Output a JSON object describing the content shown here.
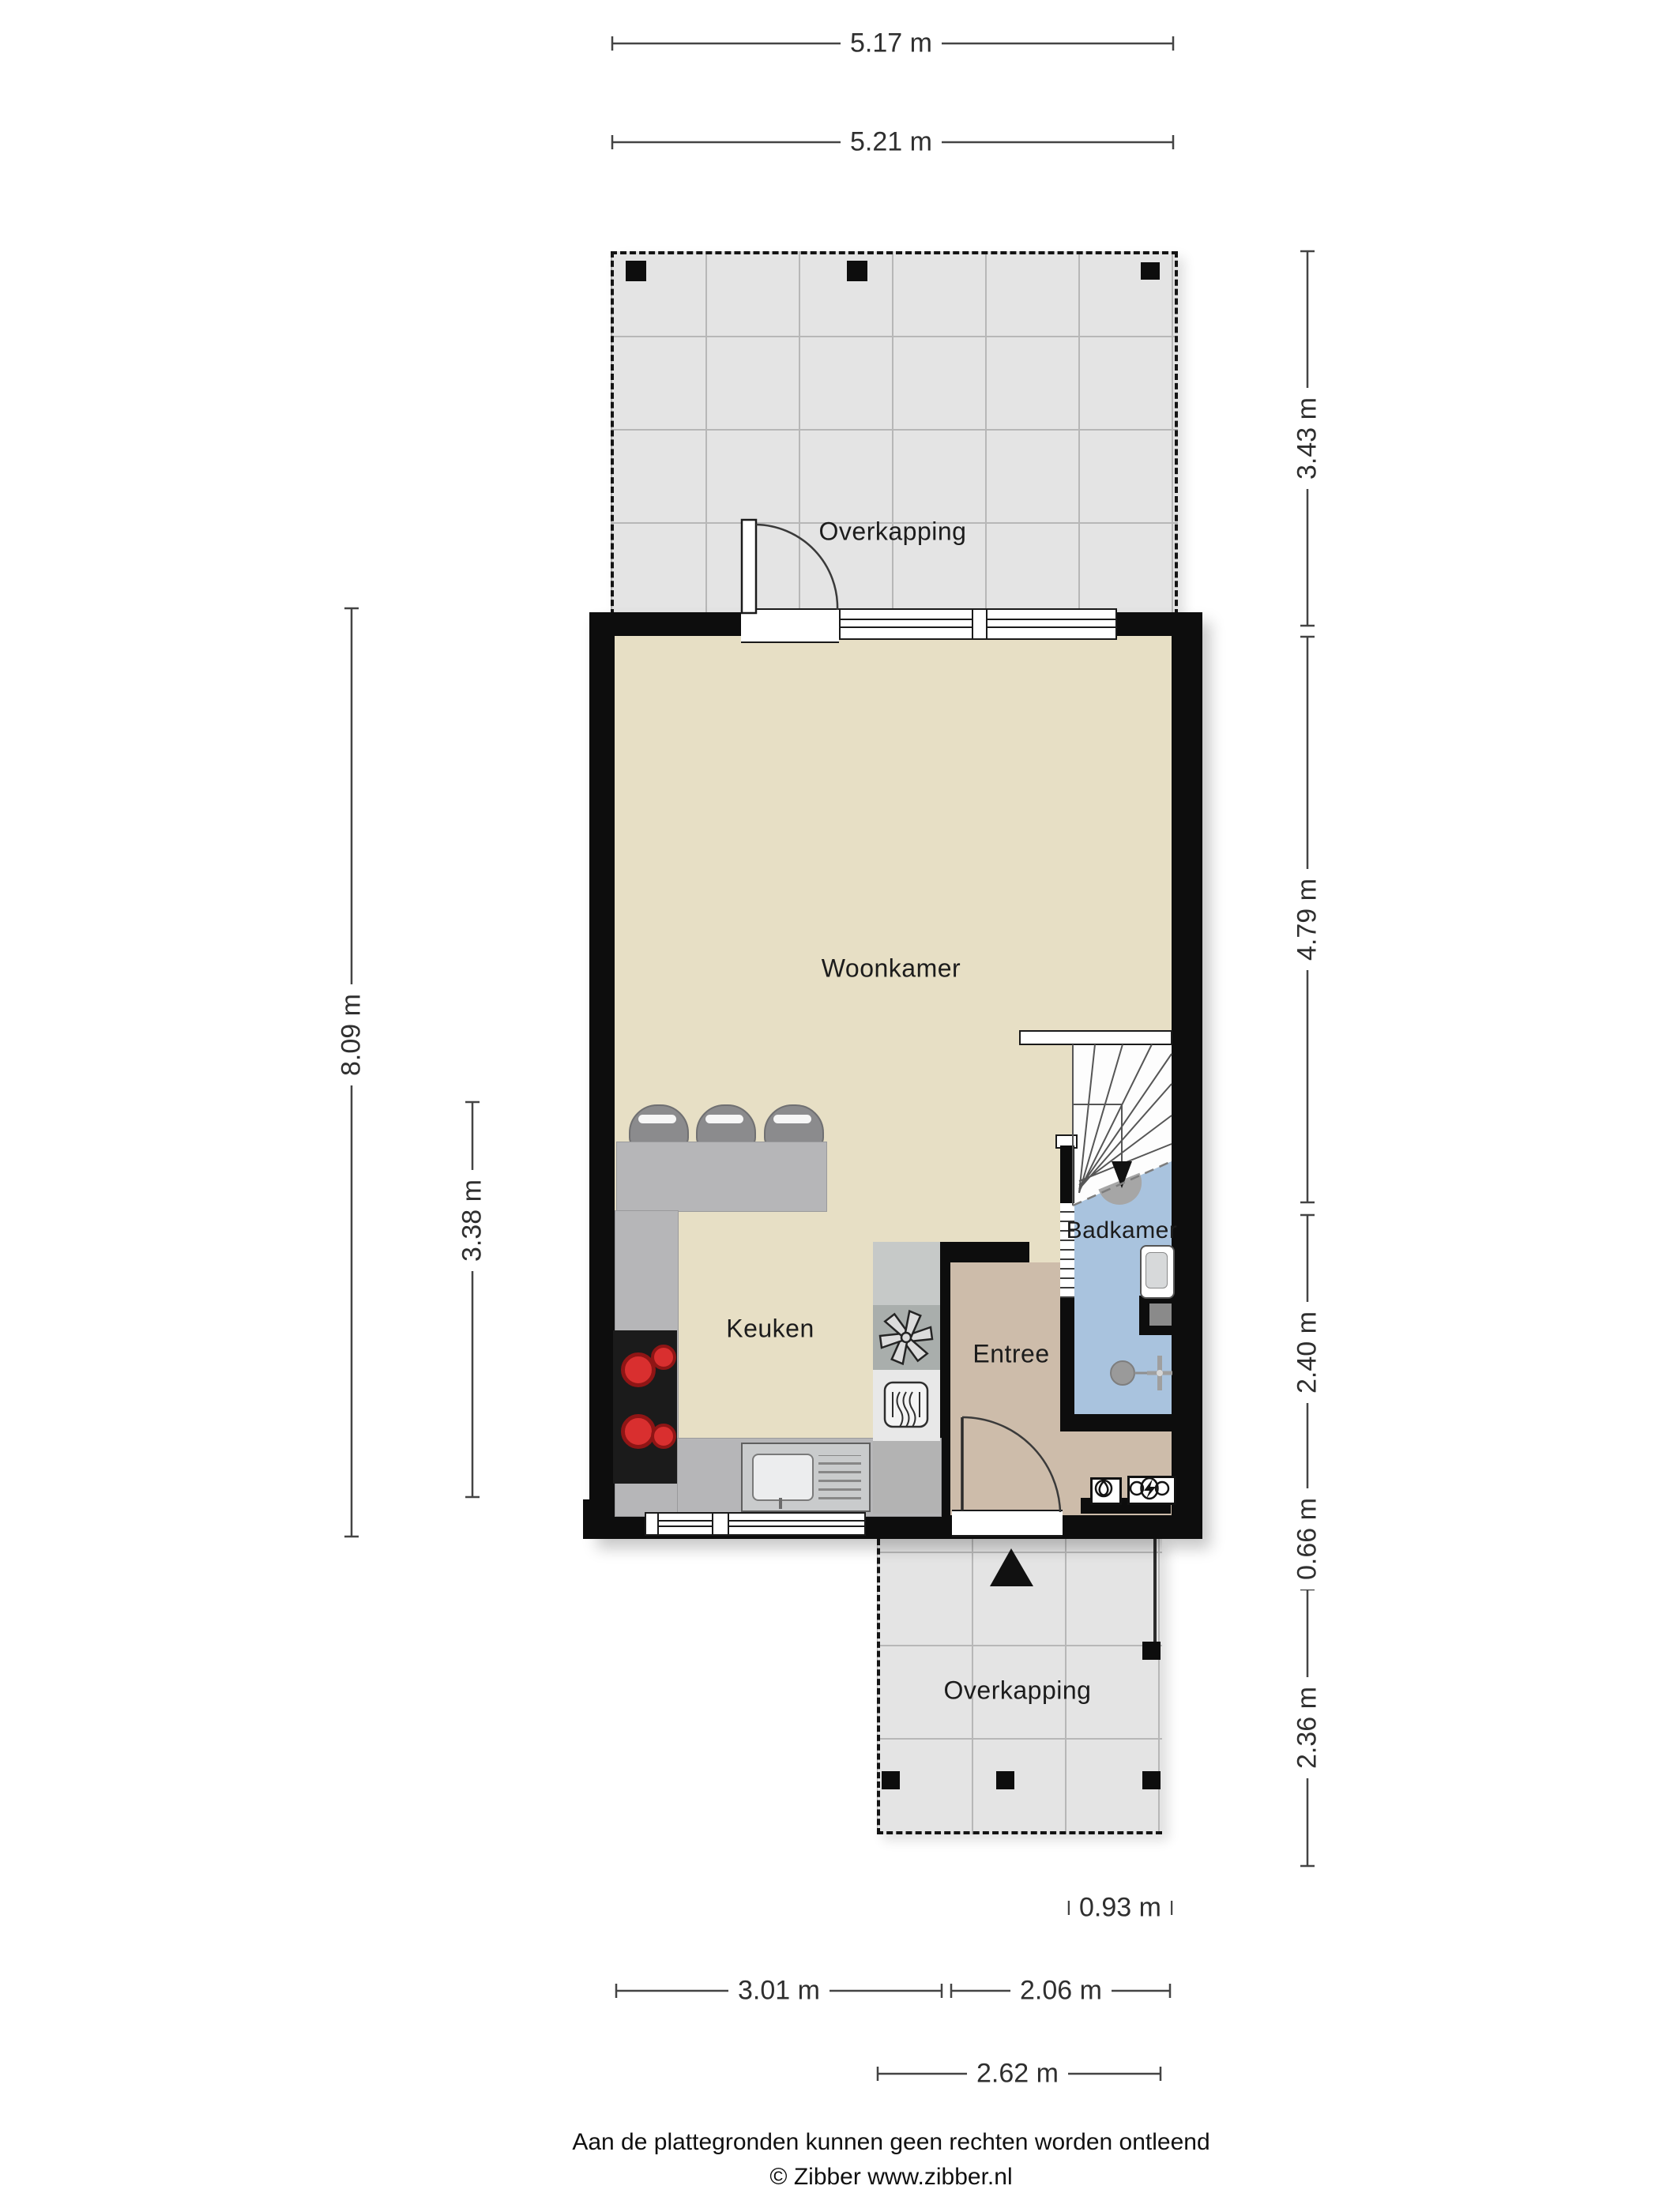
{
  "document": {
    "type": "floorplan",
    "footer_disclaimer": "Aan de plattegronden kunnen geen rechten worden ontleend",
    "footer_copyright": "© Zibber www.zibber.nl"
  },
  "rooms": {
    "overkapping_top": {
      "label": "Overkapping"
    },
    "woonkamer": {
      "label": "Woonkamer"
    },
    "keuken": {
      "label": "Keuken"
    },
    "entree": {
      "label": "Entree"
    },
    "badkamer": {
      "label": "Badkamer"
    },
    "overkapping_bottom": {
      "label": "Overkapping"
    }
  },
  "dimensions": {
    "top": [
      {
        "label": "5.17 m"
      },
      {
        "label": "5.21 m"
      }
    ],
    "left": [
      {
        "label": "8.09 m"
      },
      {
        "label": "3.38 m"
      }
    ],
    "right": [
      {
        "label": "3.43 m"
      },
      {
        "label": "4.79 m"
      },
      {
        "label": "2.40 m"
      },
      {
        "label": "0.66 m"
      },
      {
        "label": "2.36 m"
      }
    ],
    "bottom": [
      {
        "label": "0.93 m"
      },
      {
        "label": "3.01 m"
      },
      {
        "label": "2.06 m"
      },
      {
        "label": "2.62 m"
      }
    ]
  },
  "icons": {
    "north_arrow": "filled-triangle-up",
    "stair_direction": "arrow-down",
    "extractor_fan": "six-blade-fan",
    "oven": "rounded-square-steam",
    "light_point": "boxed-lamp",
    "electricity_meter": "boxed-double-circle-lightning",
    "shower_head": "half-disc",
    "bath_tap": "circle-cross-tap"
  },
  "colors": {
    "wall": "#0d0d0d",
    "living_floor": "#e7dfc5",
    "entry_floor": "#cdbcaa",
    "bath_floor": "#a9c3de",
    "canopy_floor": "#e4e4e4",
    "counter": "#b6b6b8",
    "burner": "#d92f2f",
    "dimension_line": "#444444"
  }
}
